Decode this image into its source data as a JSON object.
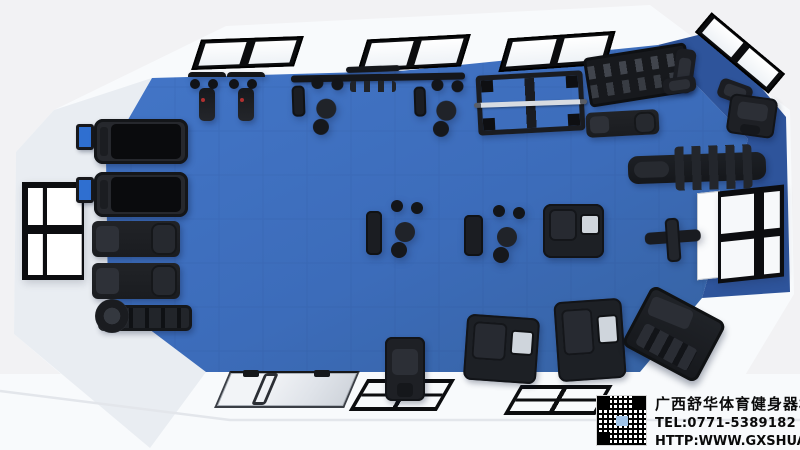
{
  "colors": {
    "background": "#f2f2f4",
    "wall": "#f8fafc",
    "wall_shade": "#e9edf2",
    "floor": "#3c6cba",
    "floor_light": "#4376c8",
    "floor_edge": "#35619f",
    "floor_dark": "#2e549b",
    "frame_black": "#0c0d10",
    "screen_blue": "#2f6fd0",
    "text": "#0a0a0a"
  },
  "icons": {
    "qr_code": "qr-code"
  },
  "watermark": {
    "company": "广西舒华体育健身器材有限公司",
    "tel": "TEL:0771-5389182",
    "url": "HTTP:WWW.GXSHUA.COM"
  },
  "scene": {
    "items": [
      {
        "name": "skylight-1",
        "type": "skylight",
        "x": 196,
        "y": 38,
        "w": 103,
        "h": 30,
        "r": -2,
        "skew": -20
      },
      {
        "name": "skylight-2",
        "type": "skylight",
        "x": 362,
        "y": 37,
        "w": 104,
        "h": 32,
        "r": -3,
        "skew": -20
      },
      {
        "name": "skylight-3",
        "type": "skylight",
        "x": 503,
        "y": 35,
        "w": 108,
        "h": 33,
        "r": -4,
        "skew": -20
      },
      {
        "name": "skylight-4",
        "type": "skylight",
        "x": 692,
        "y": 40,
        "w": 96,
        "h": 26,
        "r": 40
      },
      {
        "name": "window-left",
        "type": "winleft",
        "x": 22,
        "y": 182,
        "w": 62,
        "h": 98
      },
      {
        "name": "window-right-sash",
        "type": "sash",
        "x": 697,
        "y": 192,
        "w": 23,
        "h": 87,
        "sky": -6
      },
      {
        "name": "window-right",
        "type": "winright",
        "x": 718,
        "y": 188,
        "w": 66,
        "h": 92,
        "sky": -6
      },
      {
        "name": "entrance-glass-door",
        "type": "doorglass",
        "x": 222,
        "y": 371,
        "w": 130,
        "h": 37,
        "skew": -23
      },
      {
        "name": "door-handle-rail",
        "type": "doorrail",
        "x": 258,
        "y": 373,
        "w": 14,
        "h": 32,
        "skew": -23
      },
      {
        "name": "door-closer-1",
        "type": "doorbar",
        "x": 243,
        "y": 370,
        "w": 16,
        "h": 7
      },
      {
        "name": "door-closer-2",
        "type": "doorbar",
        "x": 314,
        "y": 370,
        "w": 16,
        "h": 7
      },
      {
        "name": "lifting-platform-1",
        "type": "platform",
        "x": 358,
        "y": 379,
        "w": 88,
        "h": 32,
        "skew": -30
      },
      {
        "name": "lifting-platform-2",
        "type": "platform",
        "x": 512,
        "y": 385,
        "w": 92,
        "h": 30,
        "skew": -30
      },
      {
        "name": "treadmill-screen-1",
        "type": "screen",
        "x": 76,
        "y": 124,
        "w": 18,
        "h": 26
      },
      {
        "name": "treadmill-1",
        "type": "treadmill",
        "x": 94,
        "y": 119,
        "w": 94,
        "h": 45
      },
      {
        "name": "treadmill-screen-2",
        "type": "screen",
        "x": 76,
        "y": 177,
        "w": 18,
        "h": 26
      },
      {
        "name": "treadmill-2",
        "type": "treadmill",
        "x": 94,
        "y": 172,
        "w": 94,
        "h": 45
      },
      {
        "name": "seated-row-machine-1",
        "type": "rowmachine",
        "x": 92,
        "y": 221,
        "w": 88,
        "h": 36
      },
      {
        "name": "seated-row-machine-2",
        "type": "rowmachine",
        "x": 92,
        "y": 263,
        "w": 88,
        "h": 36
      },
      {
        "name": "air-rower",
        "type": "rower",
        "x": 98,
        "y": 305,
        "w": 94,
        "h": 26
      },
      {
        "name": "spin-bike-1",
        "type": "bike",
        "x": 188,
        "y": 72,
        "w": 38,
        "h": 54
      },
      {
        "name": "spin-bike-2",
        "type": "bike",
        "x": 227,
        "y": 72,
        "w": 38,
        "h": 54
      },
      {
        "name": "wavy-pullup-bar",
        "type": "rig",
        "x": 346,
        "y": 66,
        "w": 54,
        "h": 6,
        "r": -2
      },
      {
        "name": "crossover-rig-beam",
        "type": "rig",
        "x": 291,
        "y": 74,
        "w": 174,
        "h": 7,
        "r": -1
      },
      {
        "name": "rig-pullup-handles",
        "type": "handles",
        "x": 350,
        "y": 81,
        "w": 46,
        "h": 11
      },
      {
        "name": "rig-station-1",
        "type": "cable",
        "x": 292,
        "y": 77,
        "w": 50,
        "h": 47,
        "r": -2
      },
      {
        "name": "rig-station-2",
        "type": "cable",
        "x": 414,
        "y": 79,
        "w": 46,
        "h": 45,
        "r": -2
      },
      {
        "name": "power-rack",
        "type": "rack",
        "x": 477,
        "y": 73,
        "w": 107,
        "h": 60,
        "r": -3
      },
      {
        "name": "barbell",
        "type": "barbell",
        "x": 474,
        "y": 101,
        "w": 113,
        "h": 5,
        "r": -2
      },
      {
        "name": "dumbbell-rack",
        "type": "rackdb",
        "x": 586,
        "y": 50,
        "w": 104,
        "h": 50,
        "r": -9
      },
      {
        "name": "adjustable-bench-1",
        "type": "benchv",
        "x": 674,
        "y": 49,
        "w": 20,
        "h": 44,
        "r": 8
      },
      {
        "name": "flat-bench-1",
        "type": "benchh",
        "x": 663,
        "y": 77,
        "w": 33,
        "h": 16,
        "r": -8
      },
      {
        "name": "incline-bench",
        "type": "benchh",
        "x": 718,
        "y": 82,
        "w": 34,
        "h": 20,
        "r": 20
      },
      {
        "name": "corner-machine",
        "type": "machine",
        "x": 728,
        "y": 96,
        "w": 48,
        "h": 40,
        "r": 8
      },
      {
        "name": "back-extension-bench",
        "type": "rowmachine",
        "x": 586,
        "y": 111,
        "w": 73,
        "h": 25,
        "r": -3
      },
      {
        "name": "situp-bench-row",
        "type": "padrow",
        "x": 628,
        "y": 154,
        "w": 138,
        "h": 28,
        "r": -2
      },
      {
        "name": "lat-pulldown-machine",
        "type": "lat",
        "x": 645,
        "y": 218,
        "w": 56,
        "h": 44,
        "r": -4
      },
      {
        "name": "cable-machine-1",
        "type": "cable",
        "x": 366,
        "y": 200,
        "w": 62,
        "h": 67
      },
      {
        "name": "cable-machine-2",
        "type": "cable",
        "x": 464,
        "y": 205,
        "w": 73,
        "h": 62
      },
      {
        "name": "selectorized-machine-1",
        "type": "machine2",
        "x": 543,
        "y": 204,
        "w": 61,
        "h": 54
      },
      {
        "name": "selectorized-machine-2",
        "type": "machine",
        "x": 385,
        "y": 337,
        "w": 40,
        "h": 64
      },
      {
        "name": "selectorized-machine-3",
        "type": "machine2",
        "x": 465,
        "y": 316,
        "w": 73,
        "h": 66,
        "r": 4
      },
      {
        "name": "selectorized-machine-4",
        "type": "machine2",
        "x": 556,
        "y": 300,
        "w": 68,
        "h": 80,
        "r": -4
      },
      {
        "name": "hack-squat-machine",
        "type": "hack",
        "x": 632,
        "y": 300,
        "w": 84,
        "h": 68,
        "r": 28
      }
    ]
  }
}
